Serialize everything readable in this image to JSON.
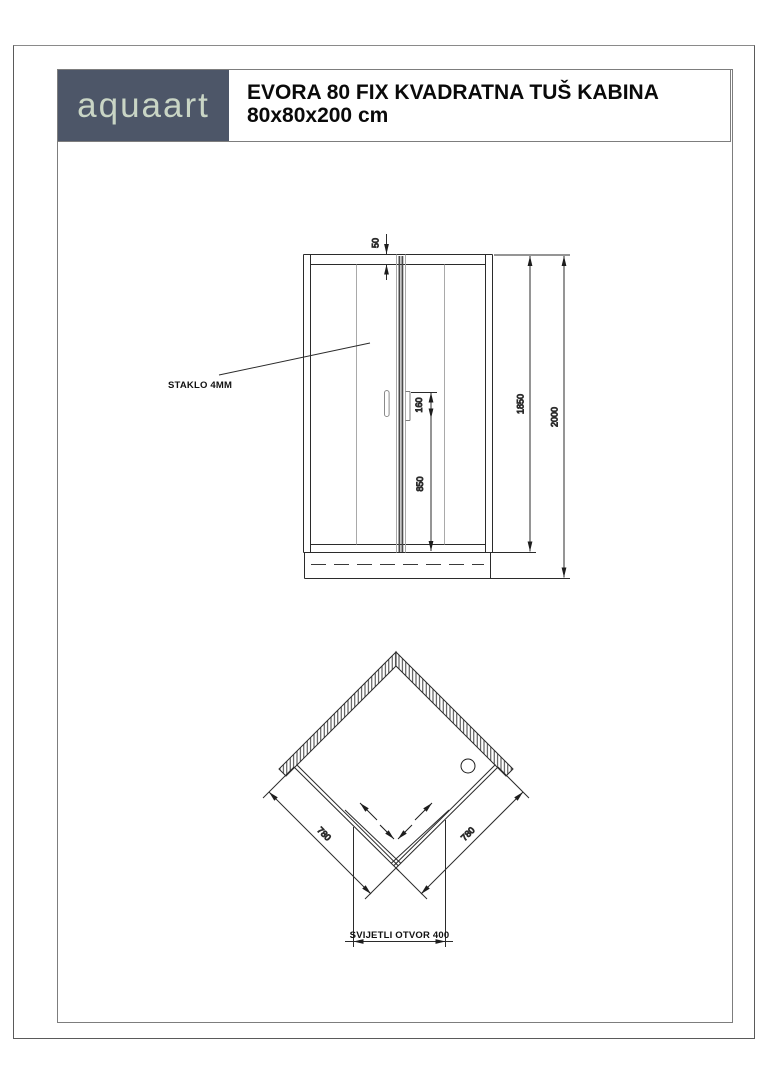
{
  "header": {
    "brand": "aquaart",
    "title_line1": "EVORA 80 FIX KVADRATNA TUŠ KABINA",
    "title_line2": "80x80x200 cm"
  },
  "colors": {
    "brand_bg": "#4d5668",
    "brand_text": "#c9d5c5",
    "line": "#2b2b2b"
  },
  "front_view": {
    "labels": {
      "top_profile_mm": "50",
      "handle_mm": "160",
      "handle_height_mm": "850",
      "cabin_height_mm": "1850",
      "total_height_mm": "2000",
      "glass_note": "STAKLO 4MM"
    }
  },
  "top_view": {
    "labels": {
      "left_side_mm": "780",
      "right_side_mm": "780",
      "clear_opening": "SVIJETLI OTVOR 400"
    }
  }
}
